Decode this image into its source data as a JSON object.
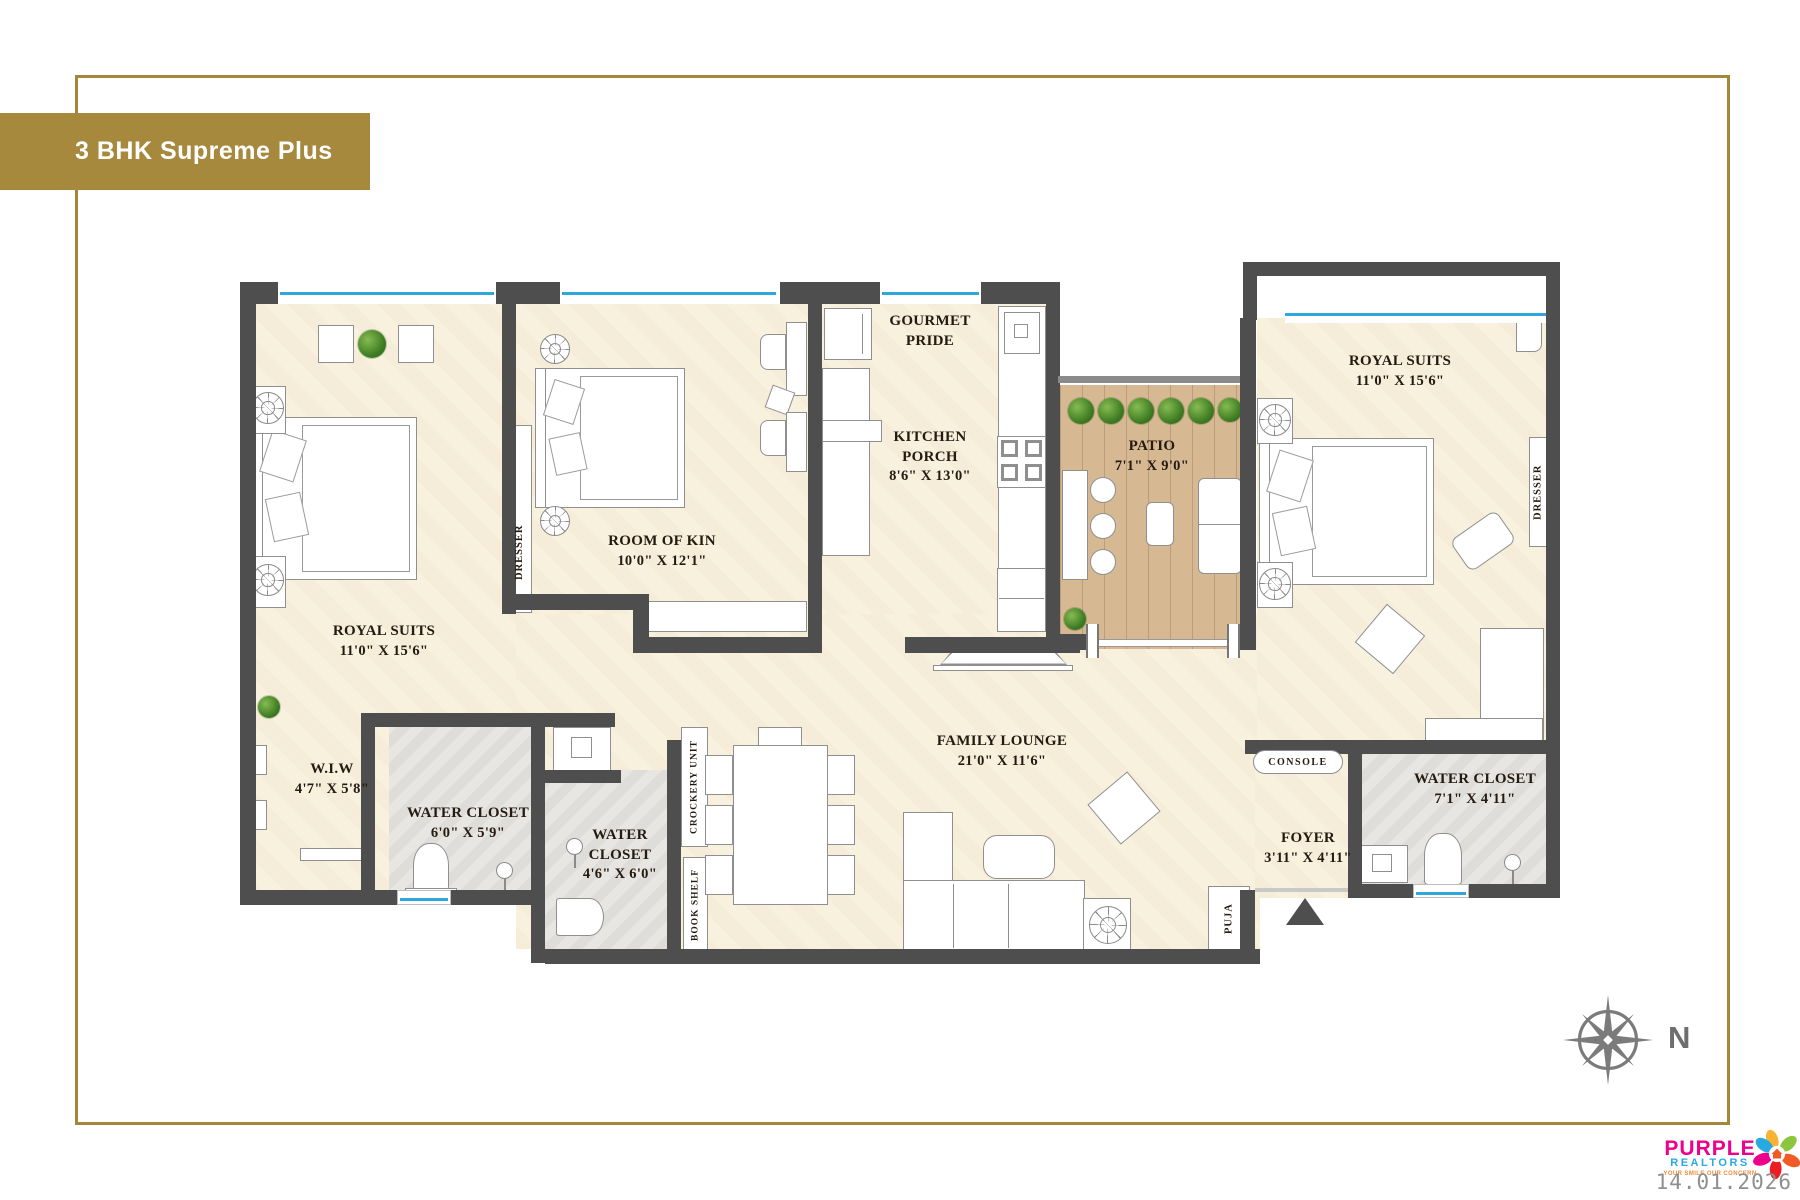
{
  "title_banner": "3 BHK Supreme Plus",
  "rooms": [
    {
      "id": "royal-suits-left",
      "name": "ROYAL SUITS",
      "dims": "11'0\" X 15'6\""
    },
    {
      "id": "room-of-kin",
      "name": "ROOM OF KIN",
      "dims": "10'0\" X 12'1\""
    },
    {
      "id": "gourmet-pride",
      "name": "GOURMET PRIDE",
      "dims": ""
    },
    {
      "id": "kitchen-porch",
      "name": "KITCHEN PORCH",
      "dims": "8'6\" X 13'0\""
    },
    {
      "id": "patio",
      "name": "PATIO",
      "dims": "7'1\" X 9'0\""
    },
    {
      "id": "royal-suits-right",
      "name": "ROYAL SUITS",
      "dims": "11'0\" X 15'6\""
    },
    {
      "id": "wiw",
      "name": "W.I.W",
      "dims": "4'7\" X 5'8\""
    },
    {
      "id": "water-closet-1",
      "name": "WATER CLOSET",
      "dims": "6'0\" X 5'9\""
    },
    {
      "id": "water-closet-2",
      "name": "WATER CLOSET",
      "dims": "4'6\" X 6'0\""
    },
    {
      "id": "family-lounge",
      "name": "FAMILY LOUNGE",
      "dims": "21'0\" X 11'6\""
    },
    {
      "id": "foyer",
      "name": "FOYER",
      "dims": "3'11\" X 4'11\""
    },
    {
      "id": "water-closet-3",
      "name": "WATER CLOSET",
      "dims": "7'1\" X 4'11\""
    }
  ],
  "annotations": {
    "console": "CONSOLE",
    "dresser_left": "DRESSER",
    "dresser_right": "DRESSER",
    "crockery_unit": "CROCKERY UNIT",
    "book_shelf": "BOOK SHELF",
    "puja": "PUJA",
    "north": "N"
  },
  "footer": {
    "brand_line1": "PURPLE",
    "brand_line2": "REALTORS",
    "brand_tagline": "YOUR SMILE OUR CONCERN",
    "date": "14.01.2026"
  },
  "colors": {
    "gold": "#A6893D",
    "wall": "#4E4E4E",
    "window_blue": "#2FA7DC",
    "floor_cream": "#F8F1DE",
    "tile_gray": "#E7E6E2",
    "patio_wood": "#D6B992"
  }
}
